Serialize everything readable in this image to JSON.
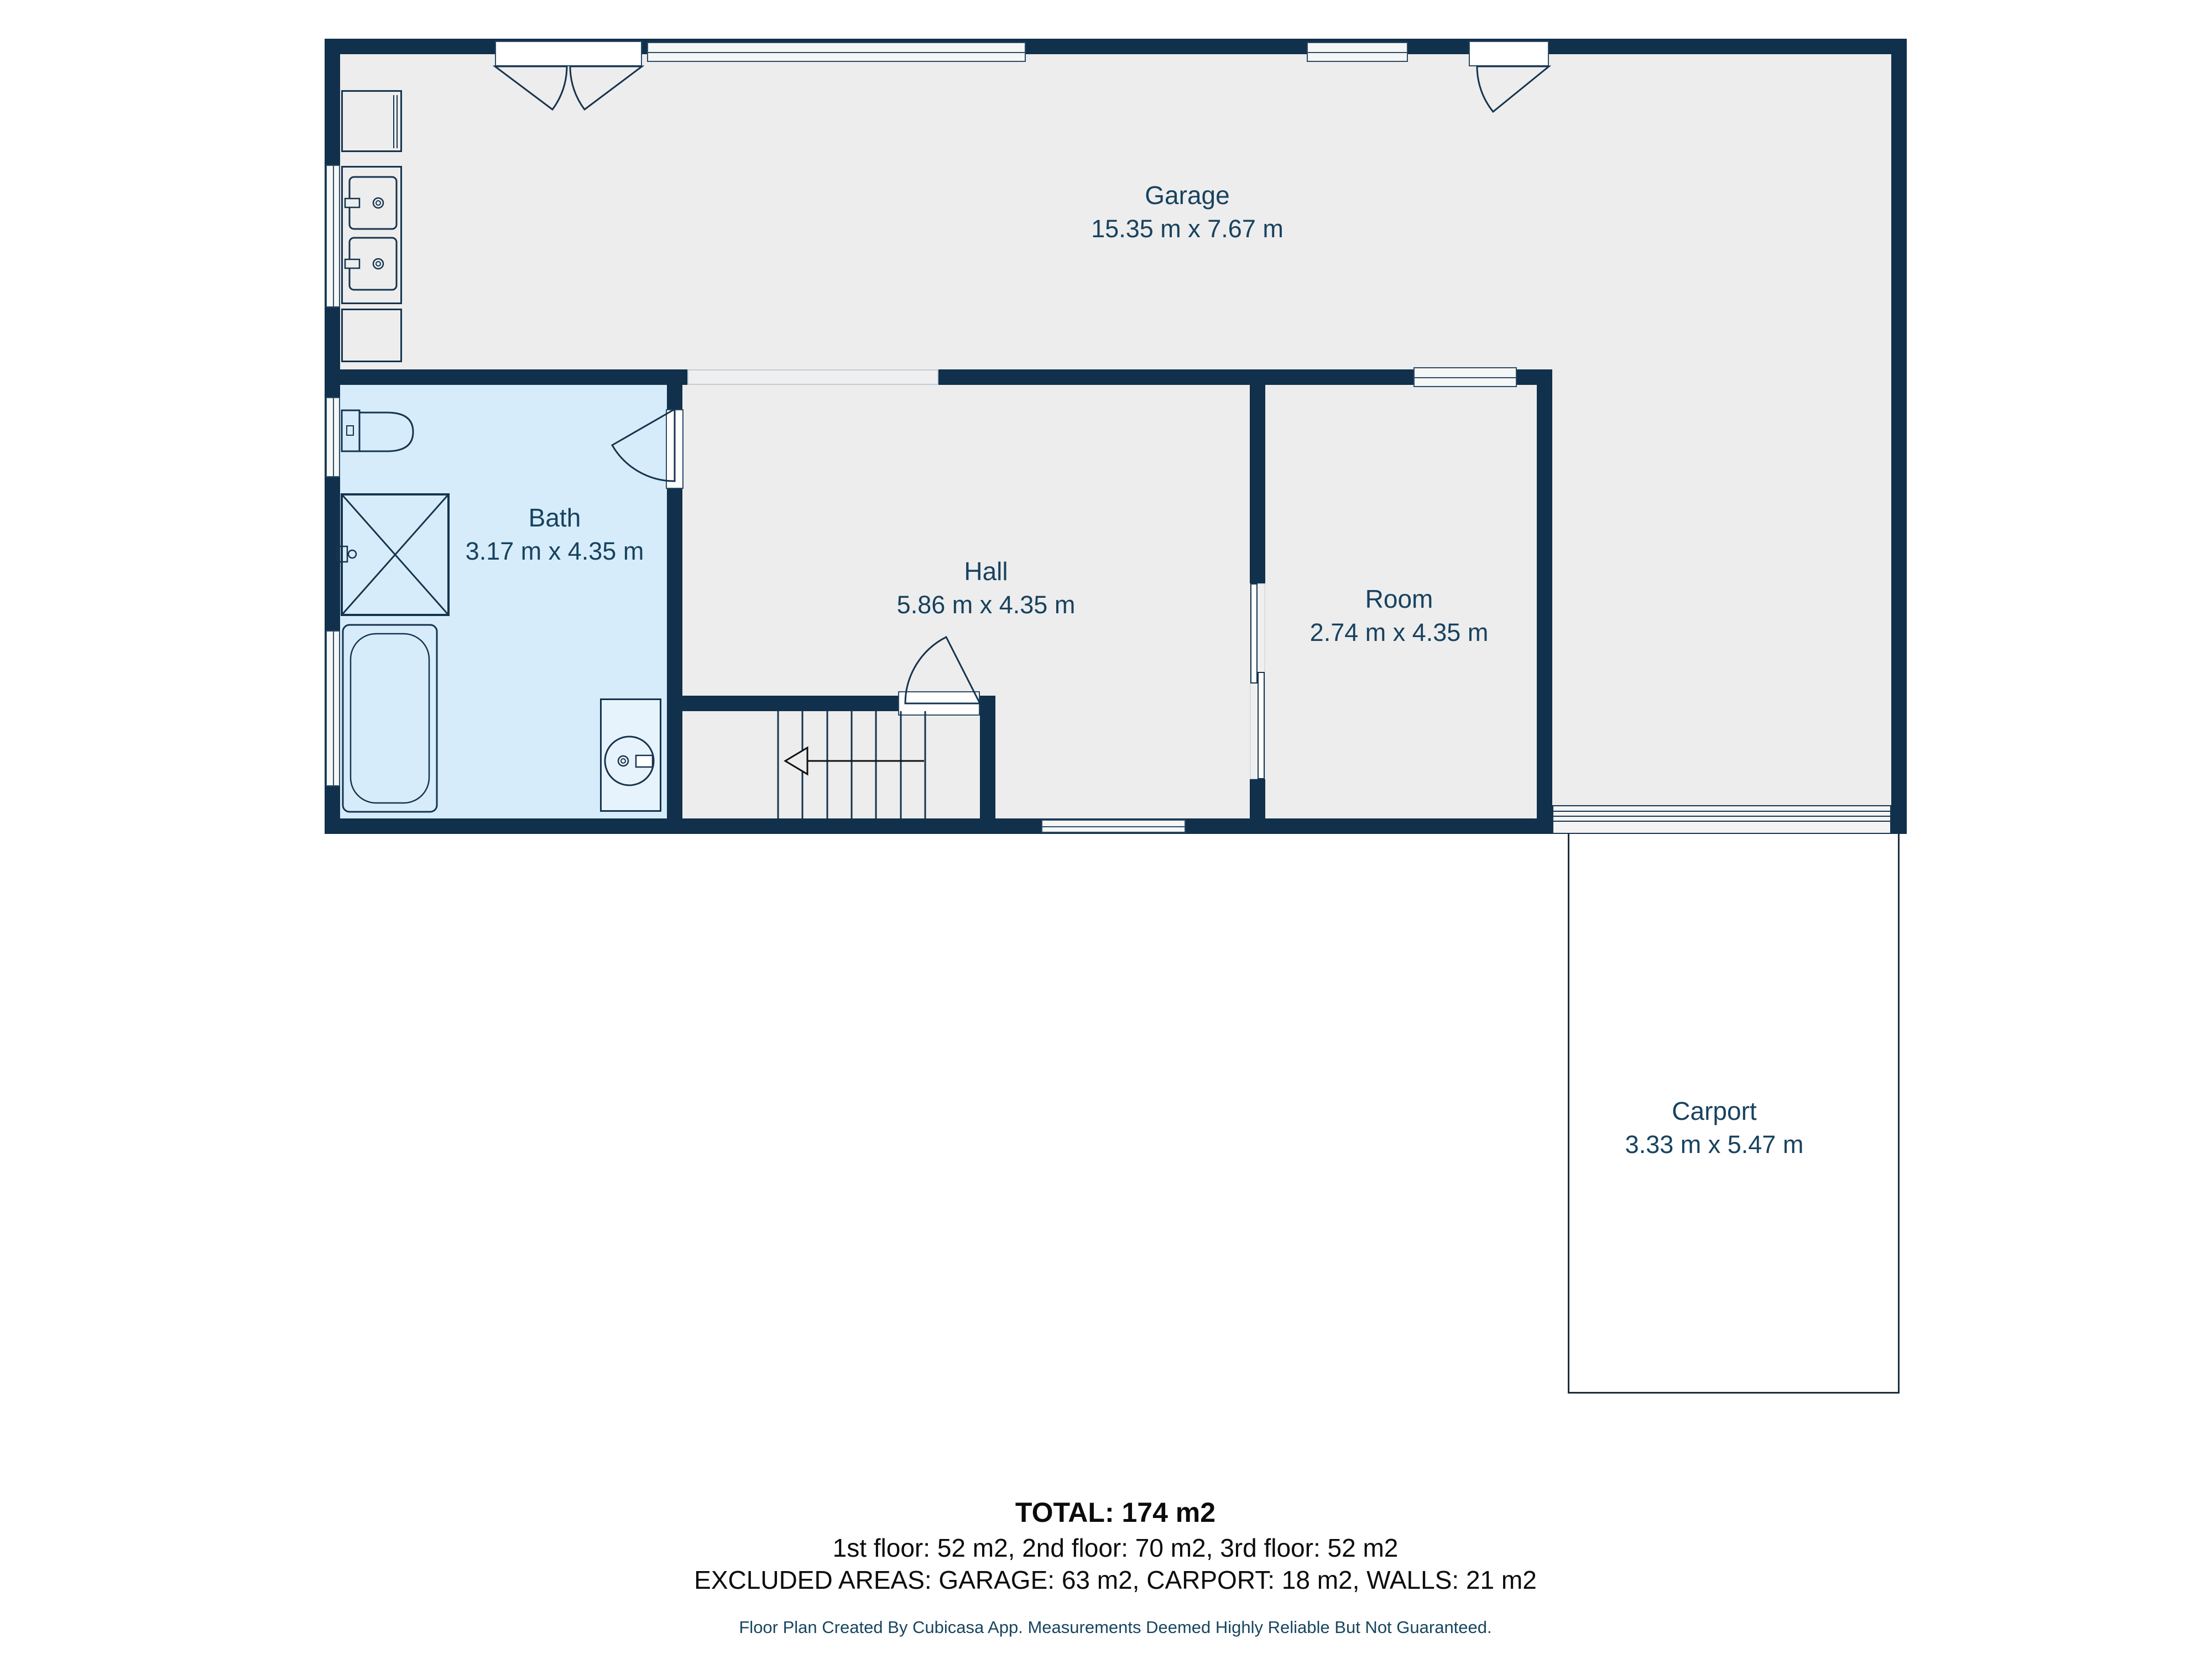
{
  "plan": {
    "rooms": [
      {
        "name": "Garage",
        "dims": "15.35 m x 7.67 m"
      },
      {
        "name": "Bath",
        "dims": "3.17 m x 4.35 m"
      },
      {
        "name": "Hall",
        "dims": "5.86 m x 4.35 m"
      },
      {
        "name": "Room",
        "dims": "2.74 m x 4.35 m"
      },
      {
        "name": "Carport",
        "dims": "3.33 m x 5.47 m"
      }
    ],
    "symbols": [
      "toilet",
      "shower",
      "bathtub",
      "washer",
      "double-sink-counter",
      "cabinet",
      "stairs",
      "door-swing",
      "sliding-door",
      "window",
      "garage-door"
    ]
  },
  "summary": {
    "total": "TOTAL: 174 m2",
    "floors": "1st floor: 52 m2, 2nd floor: 70 m2, 3rd floor: 52 m2",
    "excluded": "EXCLUDED AREAS: GARAGE: 63 m2, CARPORT: 18 m2, WALLS: 21 m2"
  },
  "footer": "Floor Plan Created By Cubicasa App. Measurements Deemed Highly Reliable But Not Guaranteed.",
  "colors": {
    "wall": "#10304b",
    "floor": "#ededed",
    "bath_floor": "#d6ecfa",
    "label_text": "#18425f",
    "summary_text": "#0c0c0c",
    "footer_text": "#17455f"
  }
}
